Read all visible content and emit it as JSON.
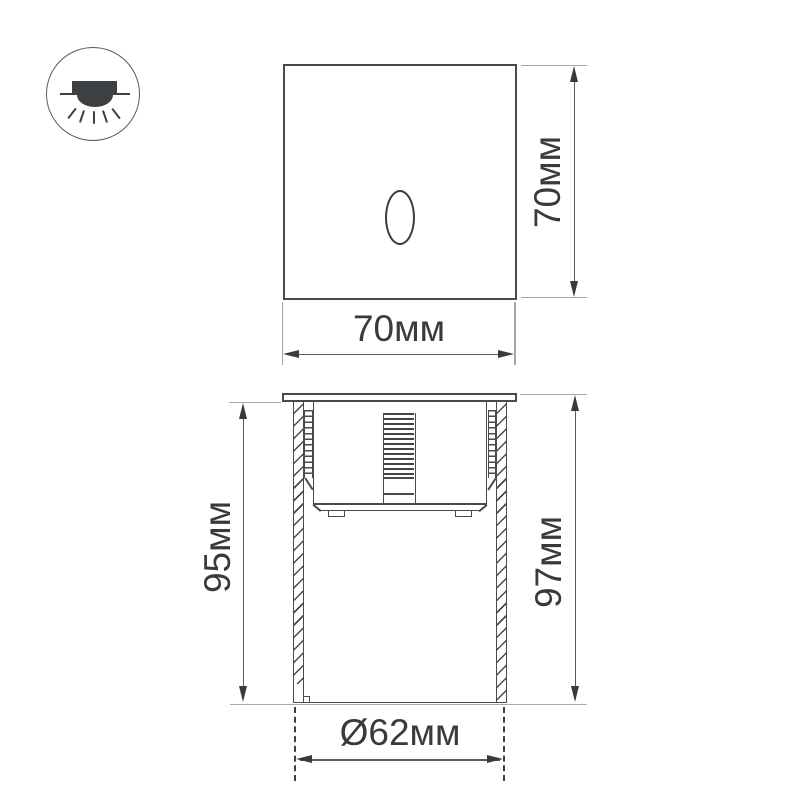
{
  "drawing": {
    "type": "product-dimension-diagram",
    "icon": "recessed-downlight-icon",
    "colors": {
      "background": "#ffffff",
      "stroke": "#4a4a4a",
      "dimension_line": "#5a5a5a",
      "extension_line": "#a6a6a6",
      "text": "#3a3a3a",
      "icon_fill": "#3d4043"
    },
    "views": {
      "front": {
        "width_label": "70мм",
        "height_label": "70мм"
      },
      "side": {
        "depth_label": "95мм",
        "height_label": "97мм",
        "diameter_label": "Ø62мм"
      }
    }
  }
}
